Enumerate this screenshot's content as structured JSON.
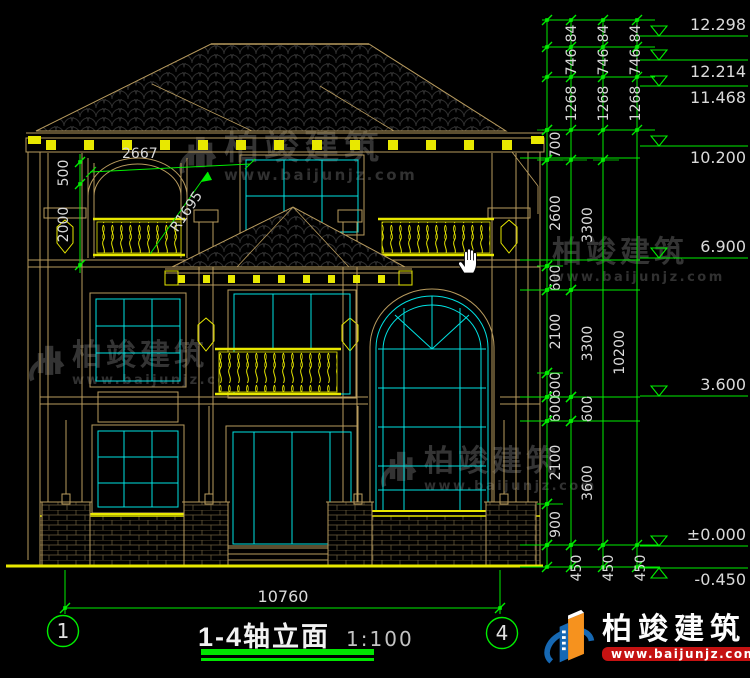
{
  "title_block": {
    "title": "1-4轴立面",
    "scale": "1:100"
  },
  "axis": {
    "start": "1",
    "end": "4"
  },
  "bottom_dim": {
    "label": "10760"
  },
  "annotations": {
    "arch_width": "2667",
    "arch_radius": "R1695",
    "upper": "500",
    "lower": "2000"
  },
  "watermark": {
    "brand": "柏竣建筑",
    "url": "www.baijunjz.com"
  },
  "brand_logo": {
    "name": "柏竣建筑",
    "url": "www.baijunjz.com"
  },
  "colors": {
    "dim_green": "#00ee00",
    "dim_text": "#dadada",
    "outline_tan": "#b89b5e",
    "accent_yellow": "#e8e800",
    "glazing_cyan": "#00e2e2",
    "logo_blue": "#1668b3",
    "logo_orange": "#f6921e",
    "url_red": "#c51212"
  },
  "left_chain": {
    "x": 80,
    "label_x": 68,
    "bounds": [
      162,
      184,
      265
    ],
    "segments": [
      [
        "500",
        162,
        184
      ],
      [
        "2000",
        184,
        265
      ]
    ]
  },
  "right_dimensions": {
    "lines_x": [
      547,
      571,
      603,
      637
    ],
    "top": {
      "labels": [
        "84",
        "746",
        "1268"
      ],
      "bounds": [
        20,
        47,
        77,
        130
      ],
      "cols_x": [
        576,
        608,
        640
      ]
    },
    "chains": [
      {
        "x": 547,
        "label_x": 560,
        "segments": [
          [
            "700",
            130,
            160
          ],
          [
            "2600",
            160,
            266
          ],
          [
            "600",
            266,
            290
          ],
          [
            "2100",
            290,
            373
          ],
          [
            "600",
            373,
            397
          ],
          [
            "600",
            397,
            421
          ],
          [
            "2100",
            421,
            504
          ],
          [
            "900",
            504,
            545
          ]
        ]
      },
      {
        "x": 571,
        "label_x": 592,
        "segments": [
          [
            "3300",
            160,
            290
          ],
          [
            "3300",
            290,
            397
          ],
          [
            "600",
            397,
            421
          ],
          [
            "3600",
            421,
            545
          ]
        ]
      },
      {
        "x": 603,
        "label_x": 624,
        "segments": [
          [
            "10200",
            160,
            545
          ]
        ]
      }
    ],
    "bottom": {
      "label": "450",
      "y0": 545,
      "y1": 567,
      "cols_x": [
        581,
        613,
        645
      ]
    },
    "extension_ys": [
      158,
      260,
      290,
      397,
      421,
      545,
      567
    ],
    "levels": [
      {
        "label": "12.298",
        "y": 36,
        "pos": "above"
      },
      {
        "label": "12.214",
        "y": 60,
        "pos": "below"
      },
      {
        "label": "11.468",
        "y": 86,
        "pos": "below"
      },
      {
        "label": "10.200",
        "y": 146,
        "pos": "below"
      },
      {
        "label": "6.900",
        "y": 258,
        "pos": "above"
      },
      {
        "label": "3.600",
        "y": 396,
        "pos": "above"
      },
      {
        "label": "±0.000",
        "y": 546,
        "pos": "above"
      },
      {
        "label": "-0.450",
        "y": 568,
        "pos": "below",
        "flip": true
      }
    ]
  }
}
